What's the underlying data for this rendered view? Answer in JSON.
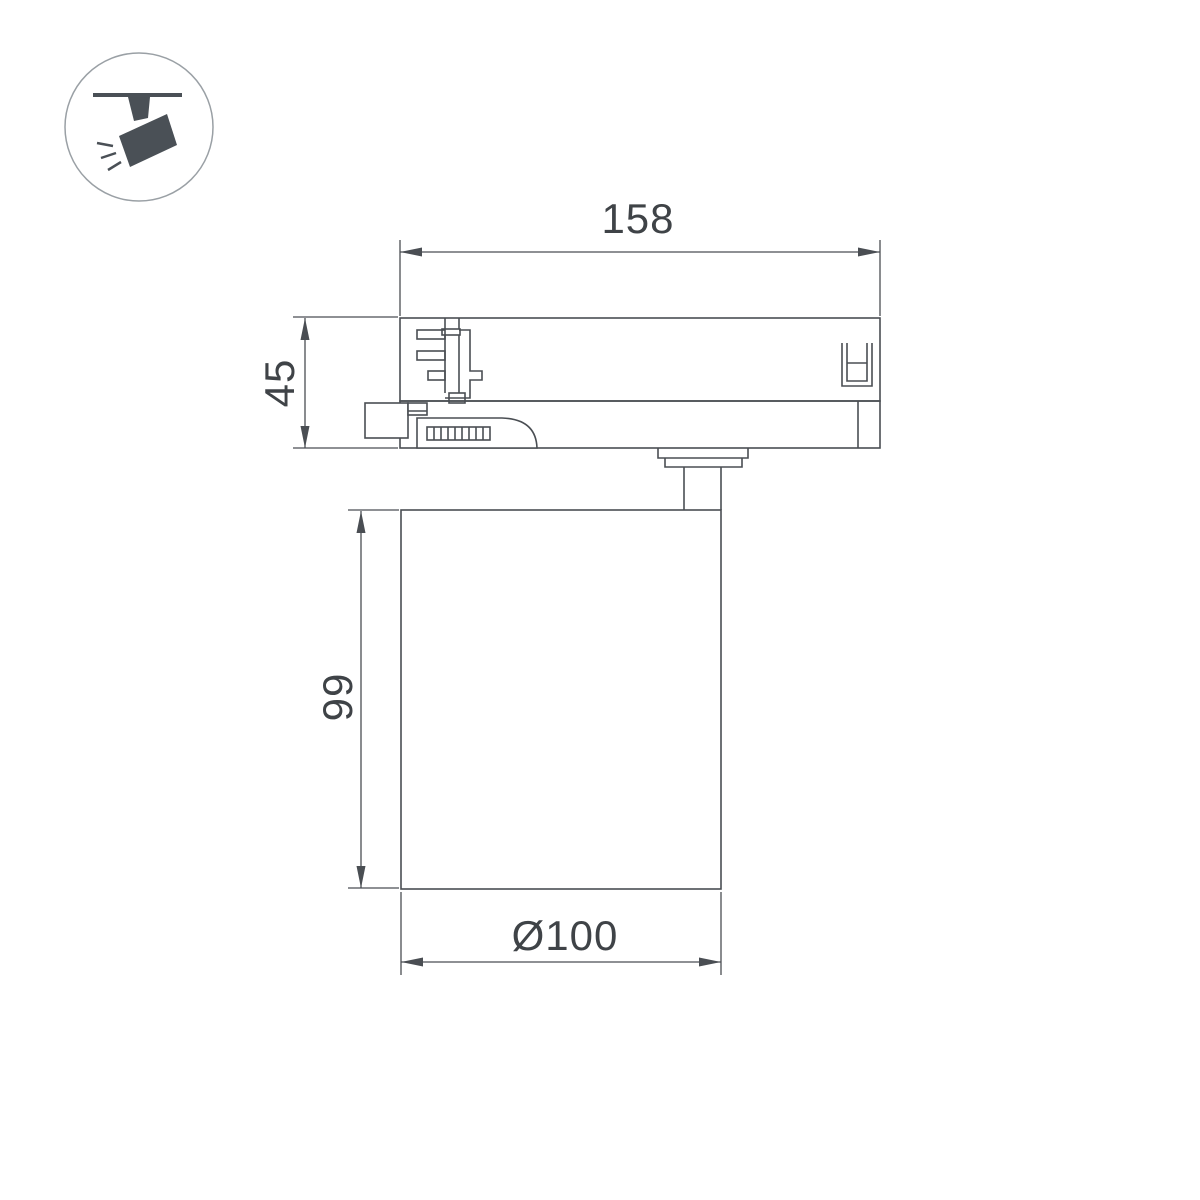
{
  "page": {
    "background": "#ffffff"
  },
  "icon": {
    "name": "track-spotlight-icon",
    "color": "#4a5056",
    "ring_color": "#9aa0a5"
  },
  "drawing": {
    "stroke_color": "#4a4e53",
    "text_color": "#3f4347",
    "dimensions": {
      "track_adapter_length": {
        "label": "158"
      },
      "track_adapter_height": {
        "label": "45"
      },
      "lamp_body_height": {
        "label": "99"
      },
      "lamp_body_diameter": {
        "label": "Ø100"
      }
    }
  }
}
